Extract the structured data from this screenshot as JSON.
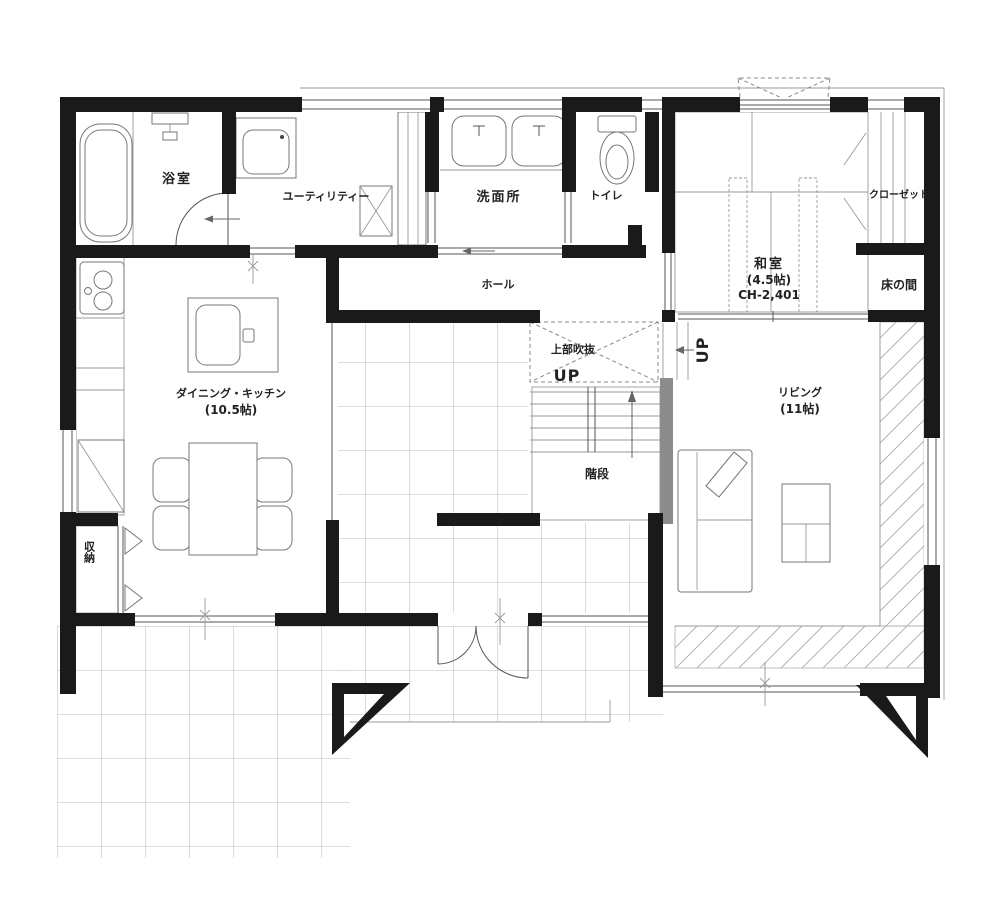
{
  "plan": {
    "rooms": {
      "bathroom": {
        "label": "浴室"
      },
      "utility": {
        "label": "ユーティリティー"
      },
      "washroom": {
        "label": "洗面所"
      },
      "toilet": {
        "label": "トイレ"
      },
      "hall": {
        "label": "ホール"
      },
      "void_above": {
        "label": "上部吹抜"
      },
      "stairs": {
        "label": "階段",
        "up_label": "UP"
      },
      "japanese_room": {
        "label": "和室",
        "size": "(4.5帖)",
        "ceiling_height": "CH-2,401"
      },
      "closet": {
        "label": "クローゼット"
      },
      "tokonoma": {
        "label": "床の間"
      },
      "dining_kitchen": {
        "label": "ダイニング・キッチン",
        "size": "(10.5帖)"
      },
      "living": {
        "label": "リビング",
        "size": "(11帖)"
      },
      "storage": {
        "label": "収納"
      }
    },
    "colors": {
      "wall": "#1a1a1a",
      "line": "#555555",
      "light_line": "#999999",
      "grid": "#a8a8a8",
      "hatch": "#b5b5b5",
      "stair_wall": "#8c8c8c",
      "background": "#ffffff"
    },
    "icons": {
      "bathtub-icon": "rounded rectangle tub outline",
      "faucet-icon": "small tap glyph on wall",
      "washing-machine-icon": "square with rounded drum",
      "laundry-pan-icon": "square with X",
      "sink-icon": "rounded basin with tap",
      "toilet-icon": "tank and oval bowl",
      "stove-icon": "cooktop with burner circles",
      "refrigerator-icon": "square with diagonal",
      "kitchen-sink-icon": "rounded basin in island",
      "dining-table-icon": "rectangle with chairs",
      "chair-icon": "rounded square",
      "sofa-icon": "rectangle with diagonal cushion",
      "low-table-icon": "divided rectangle",
      "stairs-icon": "treads with up arrow",
      "up-arrow-icon": "direction arrow",
      "bay-window-icon": "dashed trapezoid",
      "corner-post-icon": "filled hollow triangle"
    }
  }
}
